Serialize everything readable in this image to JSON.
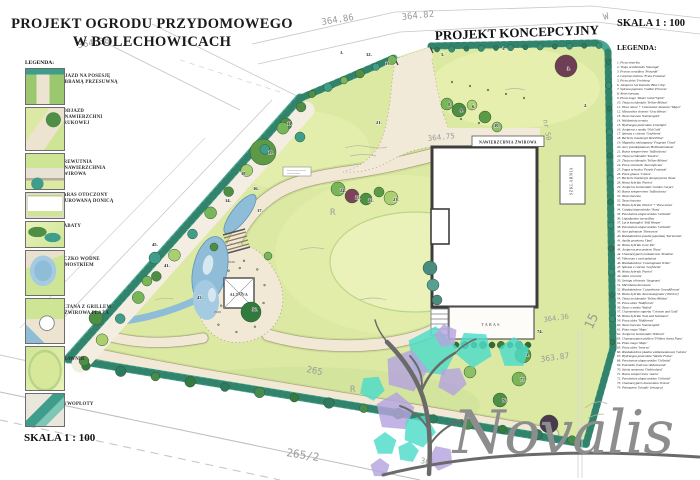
{
  "title": {
    "line1": "PROJEKT OGRODU PRZYDOMOWEGO",
    "line2": "W BOLECHOWICACH"
  },
  "subtitle": "PROJEKT KONCEPCYJNY",
  "scale_top": "SKALA 1 : 100",
  "scale_bottom": "SKALA 1 : 100",
  "logo_text": "Novalis",
  "left_legend": {
    "heading": "LEGENDA:",
    "items": [
      {
        "lines": [
          "WJAZD NA POSESJĘ",
          "Z BRAMĄ PRZESUWNĄ"
        ]
      },
      {
        "lines": [
          "PODJAZD",
          "Z NAWIERZCHNI",
          "BRUKOWEJ"
        ]
      },
      {
        "lines": [
          "DREWUTNIA",
          "+ NAWIERZCHNIA",
          "ŻWIROWA"
        ]
      },
      {
        "lines": [
          "TARAS OTOCZONY",
          "MUROWANĄ DONICĄ"
        ]
      },
      {
        "lines": [
          "RABATY"
        ]
      },
      {
        "lines": [
          "OCZKO WODNE",
          "Z MOSTKIEM"
        ]
      },
      {
        "lines": [
          "ALTANA Z GRILLEM",
          "+ ŻWIROWA PLAŻA"
        ]
      },
      {
        "lines": [
          "TRAWNIK"
        ]
      },
      {
        "lines": [
          "ŻYWOPŁOTY"
        ]
      }
    ]
  },
  "right_legend": {
    "heading": "LEGENDA:",
    "items": [
      "Picea omorika",
      "Thuja occidentalis 'Smaragd'",
      "Prunus cerasifera 'Pissardii'",
      "Carpinus betulus 'Frans Fontaine'",
      "Picea abies 'Frohburg'",
      "Juniperus horizontalis 'Blue Chip'",
      "Spiraea japonica 'Golden Princess'",
      "Abies koreana",
      "Pinus mugo 'Winter Gold'/'Ophir'",
      "Thuja occidentalis 'Yellow Ribbon'",
      "Vinca minor + Cotoneaster dammeri 'Major'",
      "Miscanthus sinensis 'Gracillimus'",
      "Taxus baccata 'Summergold'",
      "Waldsteinia ternata",
      "Hydrangea paniculata 'Limelight'",
      "Juniperus x media 'Old Gold'",
      "Spiraea x cinerea 'Grefsheim'",
      "Berberis thunbergii 'Red Pillar'",
      "Magnolia soulangeana 'Fragrant Cloud'",
      "Acer pseudoplatanus 'Brilliantissimum'",
      "Buxus sempervirens 'Suffruticosa'",
      "Thuja occidentalis 'Danica'",
      "Thuja occidentalis 'Yellow Ribbon'",
      "Picea orientalis 'Aureospicata'",
      "Fagus sylvatica 'Purple Fountain'",
      "Picea glauca 'Conica'",
      "Berberis thunbergii 'Atropurpurea Nana'",
      "Hosta hybrida 'Patriot'",
      "Juniperus horizontalis 'Golden Carpet'",
      "Buxus sempervirens 'Suffruticosa'",
      "Taxus baccata",
      "Taxus baccata",
      "Hosta hybrida 'Patriot' + Vinca minor",
      "Catalpa bignonioides 'Nana'",
      "Pennisetum alopecuroides 'Gelbstiel'",
      "Liquidambar styraciflua",
      "Larix kaempferi 'Stiff Weeper'",
      "Pennisetum alopecuroides 'Gelbstiel'",
      "Acer palmatum 'Dissectum'",
      "Rhododendron (azalia japońska) 'Kermesina'",
      "Azalia gruntowa 'Opal'",
      "Hosta hybrida 'Love Pat'",
      "Juniperus procumbens 'Nana'",
      "Chamaecyparis nootkatensis 'Pendula'",
      "Viburnum x carlcephalum",
      "Rhododendron 'Cunninghams White'",
      "Spiraea x cinerea 'Grefsheim'",
      "Hosta hybrida 'Patriot'",
      "Abies concolor",
      "Syringa chinensis 'Saugeana'",
      "Microbiota decussata",
      "Rhododendron 'Catawbiense Grandiflorum'",
      "Hosta hybrida 'Aureomarginata' ('Patriot')",
      "Thuja occidentalis 'Yellow Ribbon'",
      "Picea abies 'Nidiformis'",
      "Taxus x media 'Wojtek'",
      "Chaenomeles superba 'Crimson and Gold'",
      "Hosta hybrida 'Sum and Substance'",
      "Picea abies 'Nidiformis'",
      "Taxus baccata 'Summergold'",
      "Pinus mugo 'Mops'",
      "Juniperus horizontalis 'Wiltonii'",
      "Chamaecyparis pisifera 'Filifera Aurea Nana'",
      "Pinus mugo 'Mops'",
      "Picea abies 'Inversa'",
      "Rhododendron (Azalia wielkokwiatowa) 'Geisha'",
      "Hydrangea paniculata 'Vanille Fraise'",
      "Pennisetum alopecuroides 'Gelbstiel'",
      "Potentilla fruticosa 'Abbotswood'",
      "Salvia nemorosa 'Ostfriesland'",
      "Buxus sempervirens 'Aurea'",
      "Pennisetum alopecuroides 'Gelbstiel'",
      "Chamaecyparis lawsoniana 'Ivonne'",
      "Pelargonia 'Schadis' (wisząca)"
    ]
  },
  "plan": {
    "labels": {
      "house_court": "NAWIERZCHNIA ŻWIROWA",
      "terrace": "TARAS",
      "gazebo": "ALTANA",
      "greenhouse": "SZKLARNIA"
    },
    "plant_labels": [
      {
        "t": "1.",
        "x": 340,
        "y": 54
      },
      {
        "t": "12.",
        "x": 366,
        "y": 56
      },
      {
        "t": "13.",
        "x": 385,
        "y": 65
      },
      {
        "t": "5.",
        "x": 441,
        "y": 56
      },
      {
        "t": "1.",
        "x": 502,
        "y": 50
      },
      {
        "t": "3.",
        "x": 567,
        "y": 70
      },
      {
        "t": "2.",
        "x": 584,
        "y": 107
      },
      {
        "t": "8.",
        "x": 448,
        "y": 106
      },
      {
        "t": "9.",
        "x": 460,
        "y": 112
      },
      {
        "t": "6.",
        "x": 472,
        "y": 108
      },
      {
        "t": "10.",
        "x": 494,
        "y": 127
      },
      {
        "t": "11.",
        "x": 287,
        "y": 125
      },
      {
        "t": "19.",
        "x": 268,
        "y": 154
      },
      {
        "t": "21.",
        "x": 376,
        "y": 124
      },
      {
        "t": "24.",
        "x": 340,
        "y": 192
      },
      {
        "t": "25.",
        "x": 355,
        "y": 199
      },
      {
        "t": "22.",
        "x": 368,
        "y": 202
      },
      {
        "t": "23.",
        "x": 393,
        "y": 201
      },
      {
        "t": "18.",
        "x": 241,
        "y": 175
      },
      {
        "t": "16.",
        "x": 253,
        "y": 190
      },
      {
        "t": "14.",
        "x": 225,
        "y": 202
      },
      {
        "t": "17.",
        "x": 257,
        "y": 212
      },
      {
        "t": "45.",
        "x": 152,
        "y": 246
      },
      {
        "t": "41.",
        "x": 164,
        "y": 267
      },
      {
        "t": "43.",
        "x": 197,
        "y": 299
      },
      {
        "t": "57.",
        "x": 238,
        "y": 295
      },
      {
        "t": "56.",
        "x": 252,
        "y": 311
      },
      {
        "t": "74.",
        "x": 537,
        "y": 333
      },
      {
        "t": "71.",
        "x": 524,
        "y": 356
      },
      {
        "t": "75.",
        "x": 520,
        "y": 381
      },
      {
        "t": "76.",
        "x": 502,
        "y": 402
      }
    ],
    "survey_texts": [
      {
        "t": "364.86",
        "x": 322,
        "y": 25,
        "r": -9,
        "s": 9
      },
      {
        "t": "364.82",
        "x": 402,
        "y": 20,
        "r": -6,
        "s": 9
      },
      {
        "t": "364.38",
        "x": 78,
        "y": 48,
        "r": -9,
        "s": 9
      },
      {
        "t": "364.75",
        "x": 428,
        "y": 141,
        "r": -6,
        "s": 7.5
      },
      {
        "t": "363.87",
        "x": 541,
        "y": 362,
        "r": -8,
        "s": 8
      },
      {
        "t": "364.36",
        "x": 544,
        "y": 322,
        "r": -8,
        "s": 7
      },
      {
        "t": "265",
        "x": 306,
        "y": 372,
        "r": 11,
        "s": 9
      },
      {
        "t": "265/2",
        "x": 286,
        "y": 456,
        "r": 9,
        "s": 11
      },
      {
        "t": "365",
        "x": 420,
        "y": 463,
        "r": 10,
        "s": 8
      },
      {
        "t": "R",
        "x": 330,
        "y": 215,
        "r": 0,
        "s": 9
      },
      {
        "t": "R",
        "x": 350,
        "y": 392,
        "r": 0,
        "s": 9
      },
      {
        "t": "15",
        "x": 592,
        "y": 330,
        "r": -65,
        "s": 13
      },
      {
        "t": "nr 50",
        "x": 543,
        "y": 120,
        "r": 80,
        "s": 7
      },
      {
        "t": "W",
        "x": 604,
        "y": 20,
        "r": -15,
        "s": 9
      },
      {
        "t": "ŻWIR",
        "x": 228,
        "y": 263,
        "r": 0,
        "s": 3,
        "c": "#7a6a4f"
      },
      {
        "t": "ŻWIR",
        "x": 214,
        "y": 313,
        "r": 0,
        "s": 3,
        "c": "#7a6a4f"
      }
    ],
    "colors": {
      "hedge": "#4aa795",
      "hedge_dark": "#2c7a60",
      "lawn": "#dce9a3",
      "water": "#8fbdd8",
      "path": "#f1e9d6",
      "logo_teal": "#4ddcc9",
      "logo_purple": "#b5a4de",
      "logo_gray": "#8d8d8d"
    }
  }
}
